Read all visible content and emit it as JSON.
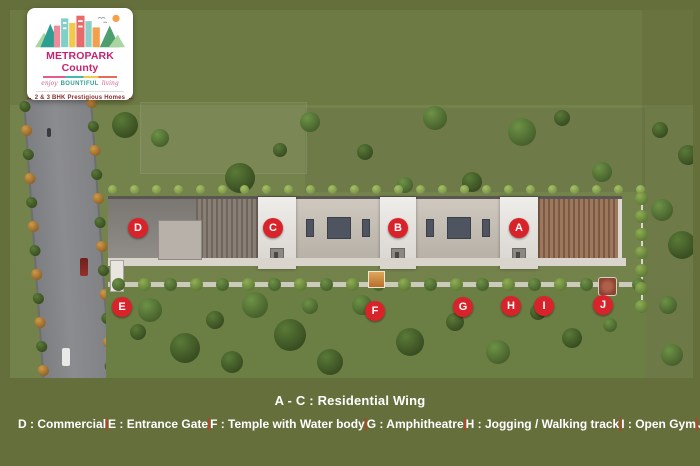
{
  "logo": {
    "title": "METROPARK County",
    "tagline_pre": "enjoy",
    "tagline_mid": "BOUNTIFUL",
    "tagline_post": "living",
    "subtitle": "2 & 3 BHK Prestigious Homes"
  },
  "markers": [
    {
      "letter": "A"
    },
    {
      "letter": "B"
    },
    {
      "letter": "C"
    },
    {
      "letter": "D"
    },
    {
      "letter": "E"
    },
    {
      "letter": "F"
    },
    {
      "letter": "G"
    },
    {
      "letter": "H"
    },
    {
      "letter": "I"
    },
    {
      "letter": "J"
    }
  ],
  "legend": {
    "residential": "A - C : Residential Wing",
    "items": [
      "D : Commercial",
      "E : Entrance Gate",
      "F : Temple with Water body",
      "G : Amphitheatre",
      "H : Jogging / Walking track",
      "I : Open Gym",
      "J : Gazebo"
    ]
  },
  "colors": {
    "background_olive": "#656f3c",
    "marker_red": "#d9232b",
    "brand_magenta": "#c9216f",
    "legend_separator_red": "#a84b2b"
  }
}
